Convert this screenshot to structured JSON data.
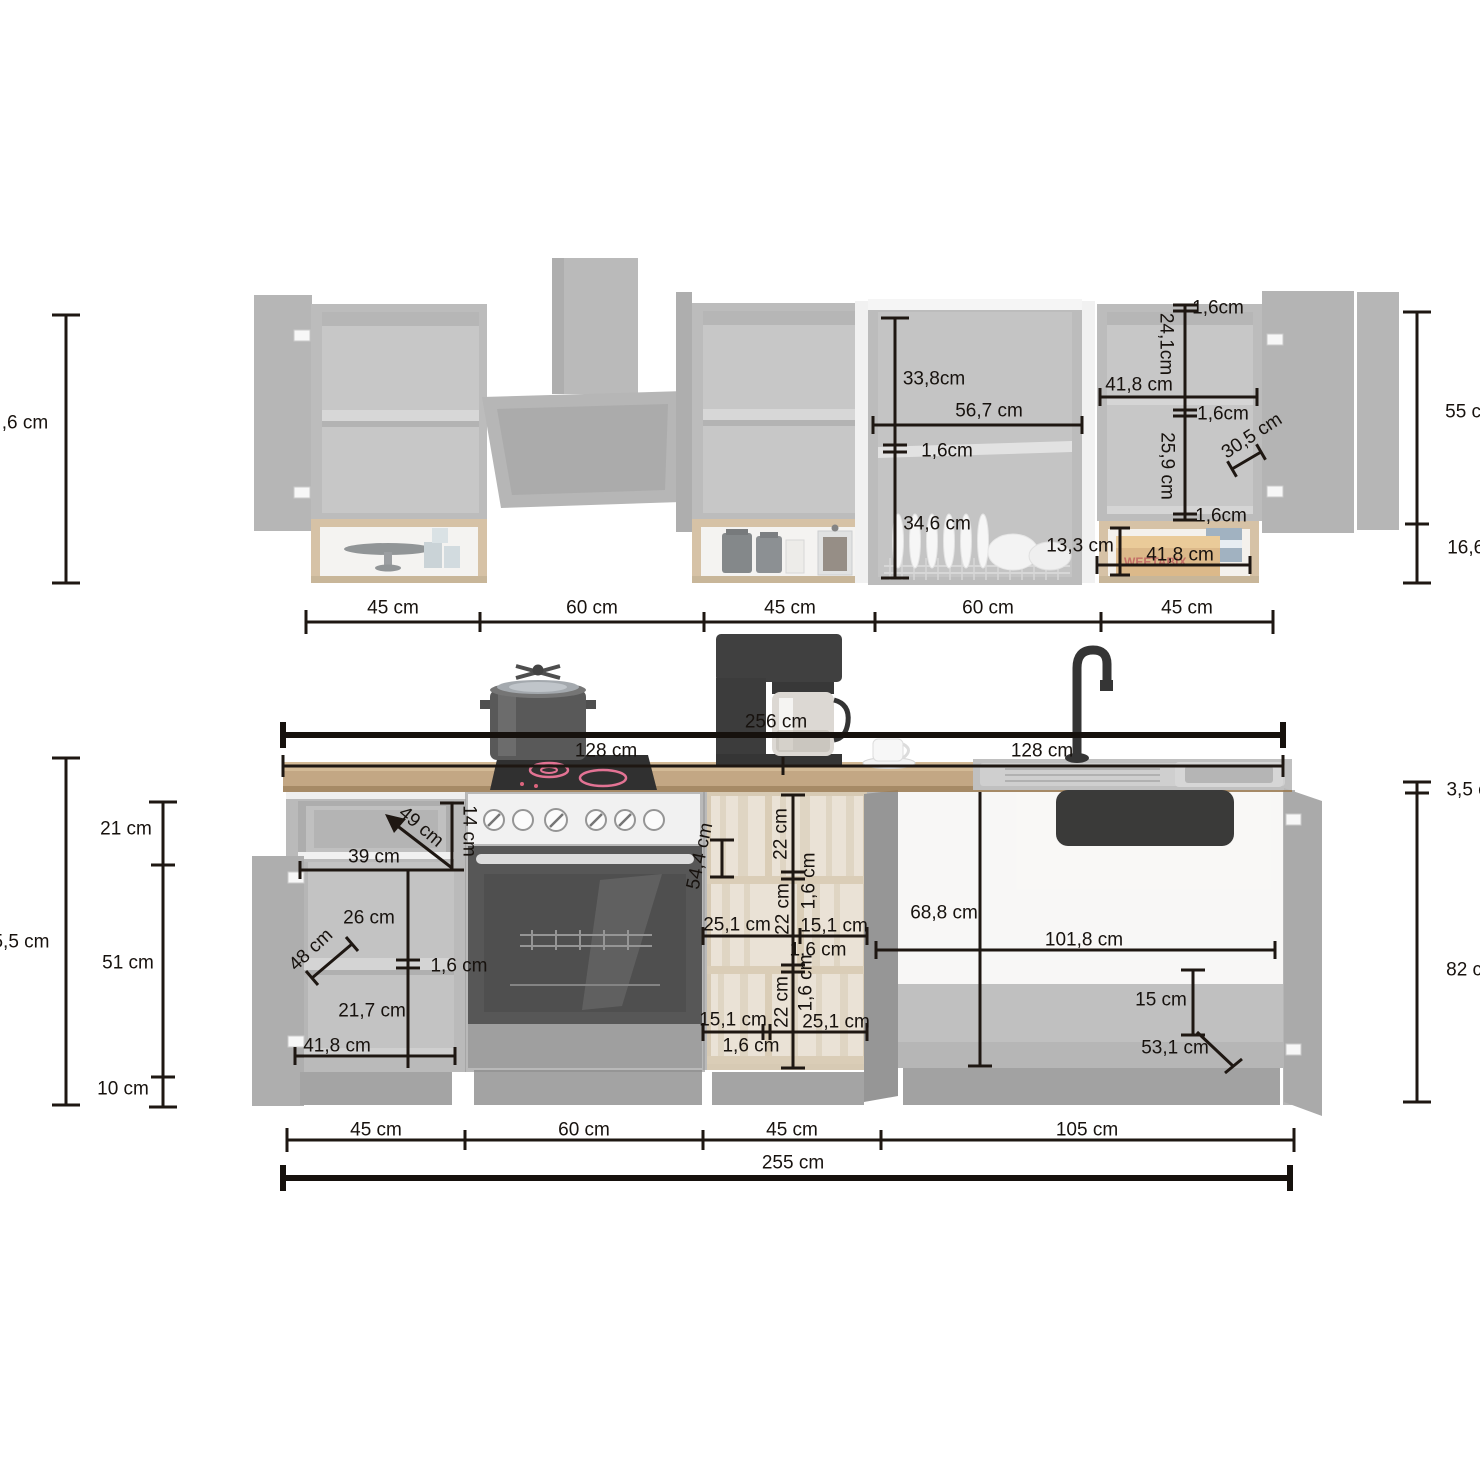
{
  "diagram": {
    "type": "kitchen-dimension-diagram",
    "unit": "cm",
    "colors": {
      "dimension_line": "#1e1712",
      "label_text": "#17120e",
      "cabinet_gray": "#a3a3a3",
      "cabinet_interior": "#b0b0b0",
      "wood_frame": "#c7ab85",
      "pale_wood": "#e2d8c7",
      "countertop": "#bd9e76",
      "appliance_dark": "#2a2a2a",
      "hob_ring_accent": "#e06488",
      "background": "#ffffff"
    },
    "wall_row_widths": [
      "45 cm",
      "60 cm",
      "45 cm",
      "60 cm",
      "45 cm"
    ],
    "base_row_widths": [
      "45 cm",
      "60 cm",
      "45 cm",
      "105 cm"
    ],
    "totals": {
      "countertop_length": "256 cm",
      "countertop_half": "128 cm",
      "base_row_total": "255 cm",
      "wall_cabinet_height": "55 cm",
      "open_shelf_height": "16,6 cm",
      "base_height_right": "82 cm",
      "countertop_thickness": "3,5 cm"
    },
    "illustration": {
      "cereal_brand": "WEETABIX"
    },
    "labels": [
      {
        "t": ",6 cm",
        "x": 25,
        "y": 423
      },
      {
        "t": "55 cm",
        "x": 1471,
        "y": 412
      },
      {
        "t": "16,6 cm",
        "x": 1481,
        "y": 548
      },
      {
        "t": "45 cm",
        "x": 393,
        "y": 608
      },
      {
        "t": "60 cm",
        "x": 592,
        "y": 608
      },
      {
        "t": "45 cm",
        "x": 790,
        "y": 608
      },
      {
        "t": "60 cm",
        "x": 988,
        "y": 608
      },
      {
        "t": "45 cm",
        "x": 1187,
        "y": 608
      },
      {
        "t": "1,6cm",
        "x": 1218,
        "y": 308
      },
      {
        "t": "24,1cm",
        "x": 1166,
        "y": 344,
        "r": 90
      },
      {
        "t": "41,8 cm",
        "x": 1139,
        "y": 385
      },
      {
        "t": "1,6cm",
        "x": 1223,
        "y": 414
      },
      {
        "t": "25,9 cm",
        "x": 1167,
        "y": 466,
        "r": 90
      },
      {
        "t": "30,5 cm",
        "x": 1252,
        "y": 436,
        "r": -33
      },
      {
        "t": "1,6cm",
        "x": 1221,
        "y": 516
      },
      {
        "t": "13,3 cm",
        "x": 1080,
        "y": 546
      },
      {
        "t": "41,8 cm",
        "x": 1180,
        "y": 555
      },
      {
        "t": "33,8cm",
        "x": 934,
        "y": 379
      },
      {
        "t": "56,7 cm",
        "x": 989,
        "y": 411
      },
      {
        "t": "1,6cm",
        "x": 947,
        "y": 451
      },
      {
        "t": "34,6 cm",
        "x": 937,
        "y": 524
      },
      {
        "t": "256 cm",
        "x": 776,
        "y": 722
      },
      {
        "t": "128 cm",
        "x": 606,
        "y": 751
      },
      {
        "t": "128 cm",
        "x": 1042,
        "y": 751
      },
      {
        "t": "3,5 cm",
        "x": 1475,
        "y": 790
      },
      {
        "t": "82 cm",
        "x": 1472,
        "y": 970
      },
      {
        "t": "5,5 cm",
        "x": 21,
        "y": 942
      },
      {
        "t": "21 cm",
        "x": 126,
        "y": 829
      },
      {
        "t": "51 cm",
        "x": 128,
        "y": 963
      },
      {
        "t": "10 cm",
        "x": 123,
        "y": 1089
      },
      {
        "t": "49 cm",
        "x": 421,
        "y": 827,
        "r": 40
      },
      {
        "t": "14 cm",
        "x": 469,
        "y": 831,
        "r": 90
      },
      {
        "t": "39 cm",
        "x": 374,
        "y": 857
      },
      {
        "t": "26 cm",
        "x": 369,
        "y": 918
      },
      {
        "t": "48 cm",
        "x": 311,
        "y": 950,
        "r": -43
      },
      {
        "t": "1,6 cm",
        "x": 459,
        "y": 966
      },
      {
        "t": "21,7 cm",
        "x": 372,
        "y": 1011
      },
      {
        "t": "41,8 cm",
        "x": 337,
        "y": 1046
      },
      {
        "t": "54,4 cm",
        "x": 700,
        "y": 856,
        "r": -78
      },
      {
        "t": "22 cm",
        "x": 781,
        "y": 834,
        "r": -90
      },
      {
        "t": "1,6 cm",
        "x": 809,
        "y": 881,
        "r": -90
      },
      {
        "t": "22 cm",
        "x": 783,
        "y": 909,
        "r": -90
      },
      {
        "t": "25,1 cm",
        "x": 737,
        "y": 925
      },
      {
        "t": "15,1 cm",
        "x": 834,
        "y": 926
      },
      {
        "t": "1,6 cm",
        "x": 818,
        "y": 950
      },
      {
        "t": "1,6 cm",
        "x": 806,
        "y": 983,
        "r": -90
      },
      {
        "t": "22 cm",
        "x": 782,
        "y": 1002,
        "r": -90
      },
      {
        "t": "15,1 cm",
        "x": 733,
        "y": 1020
      },
      {
        "t": "25,1 cm",
        "x": 836,
        "y": 1022
      },
      {
        "t": "1,6 cm",
        "x": 751,
        "y": 1046
      },
      {
        "t": "68,8 cm",
        "x": 944,
        "y": 913
      },
      {
        "t": "101,8 cm",
        "x": 1084,
        "y": 940
      },
      {
        "t": "15 cm",
        "x": 1161,
        "y": 1000
      },
      {
        "t": "53,1 cm",
        "x": 1175,
        "y": 1048
      },
      {
        "t": "45 cm",
        "x": 376,
        "y": 1130
      },
      {
        "t": "60 cm",
        "x": 584,
        "y": 1130
      },
      {
        "t": "45 cm",
        "x": 792,
        "y": 1130
      },
      {
        "t": "105 cm",
        "x": 1087,
        "y": 1130
      },
      {
        "t": "255 cm",
        "x": 793,
        "y": 1163
      }
    ]
  }
}
